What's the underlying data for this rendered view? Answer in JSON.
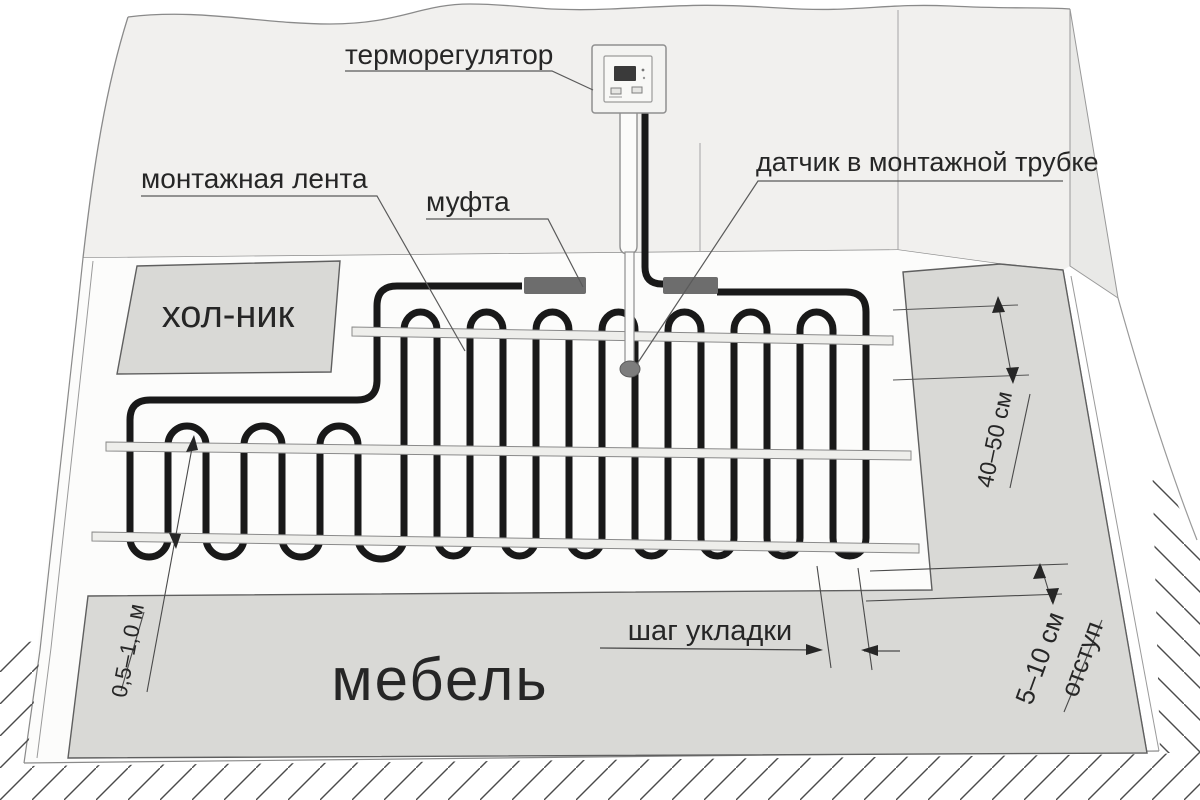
{
  "diagram": {
    "labels": {
      "thermostat": "терморегулятор",
      "mounting_tape": "монтажная лента",
      "coupling": "муфта",
      "sensor": "датчик в монтажной трубке",
      "fridge_zone": "хол-ник",
      "furniture_zone": "мебель",
      "laying_pitch": "шаг укладки"
    },
    "dimensions": {
      "wall_to_mat": "40–50 см",
      "offset_value": "5–10 см",
      "offset_word": "отступ",
      "loop_length": "0,5–1,0 м"
    },
    "colors": {
      "cable": "#191919",
      "wall": "#f1f0ee",
      "floor": "#fcfcfb",
      "zone_gray": "#d9d9d6",
      "coupling_gray": "#6d6d6d",
      "tape": "#eeeeeb",
      "line": "#777777",
      "text": "#262626"
    }
  }
}
